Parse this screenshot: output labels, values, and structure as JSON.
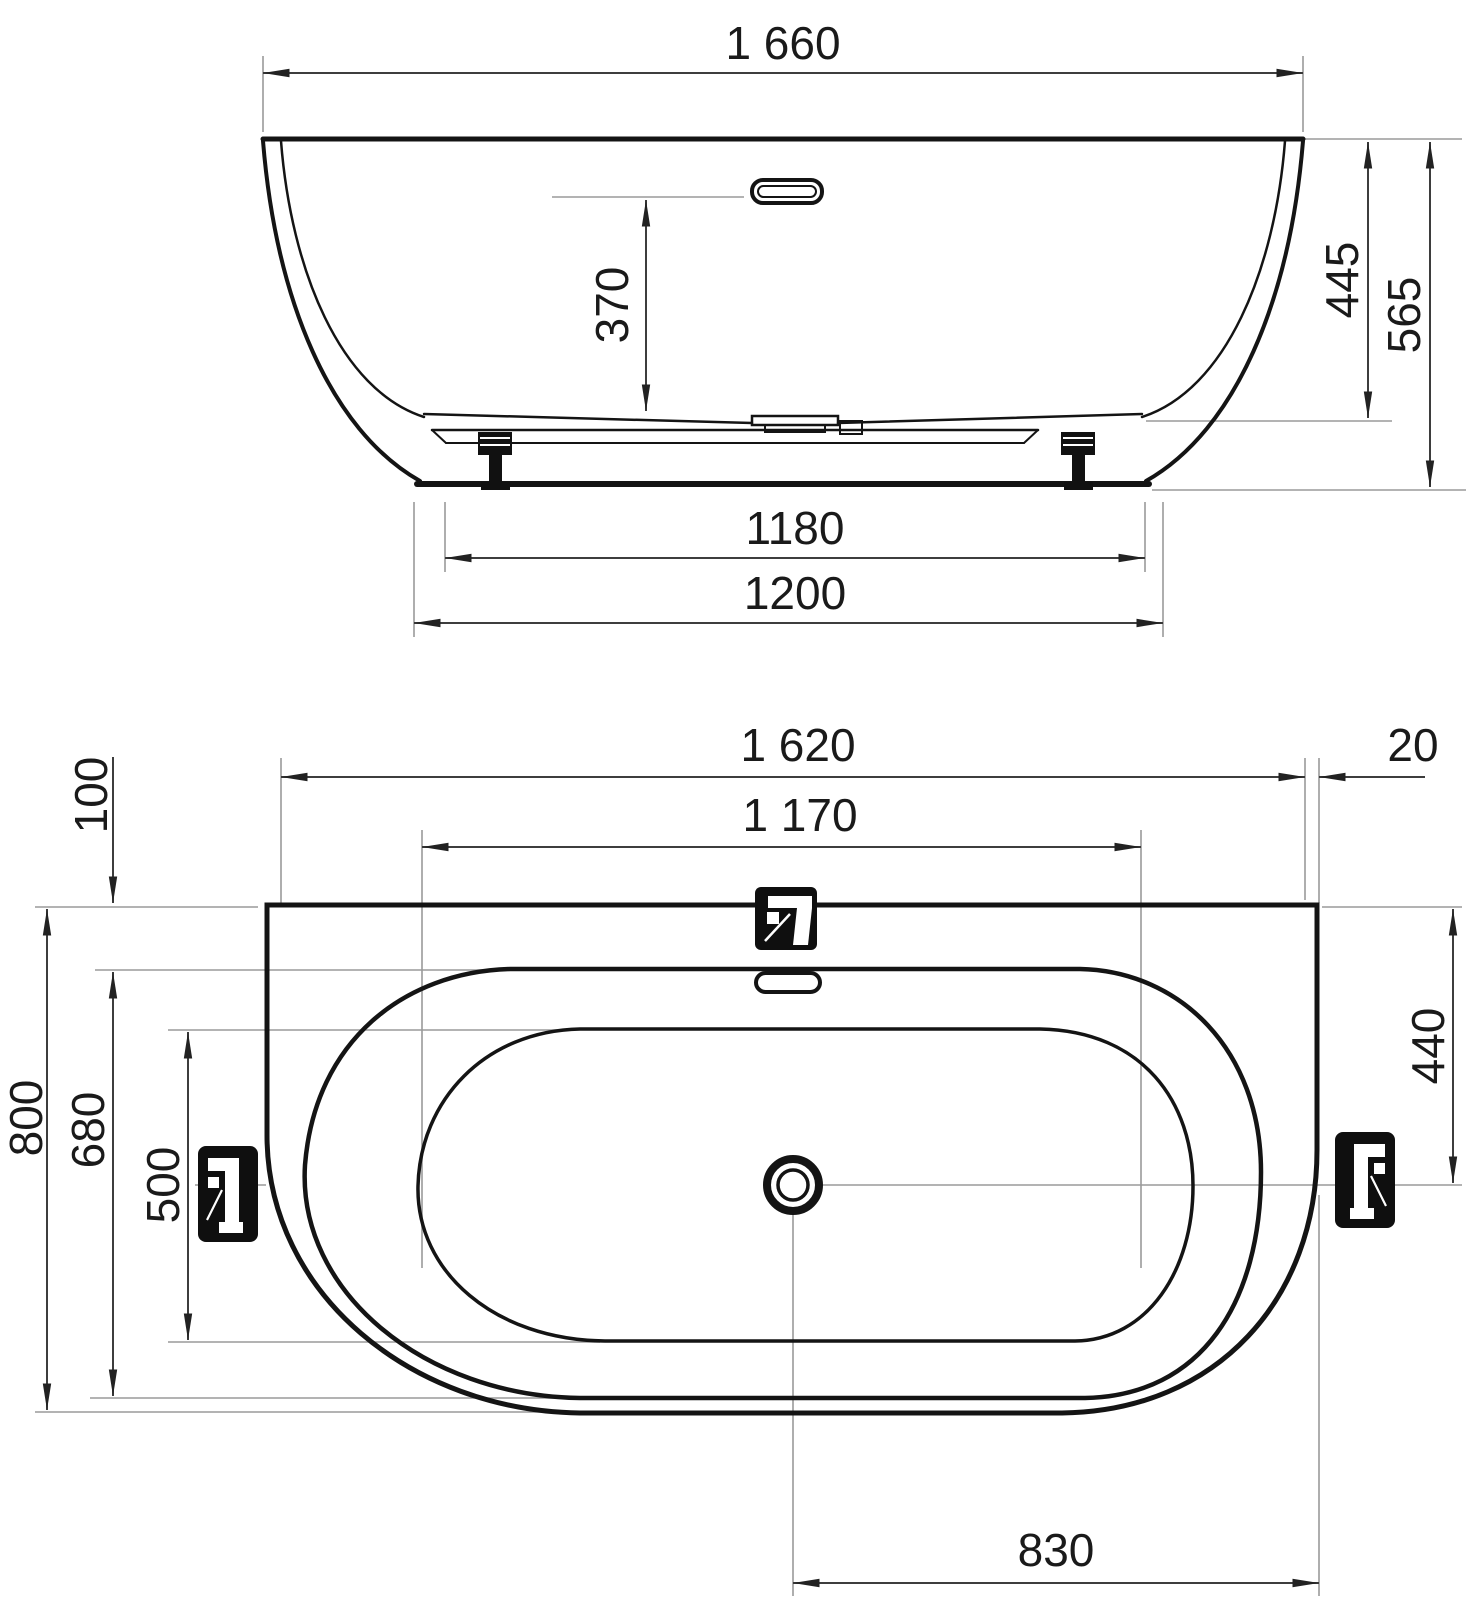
{
  "drawing": {
    "kind": "technical-dimension-drawing",
    "subject": "wall-faced freestanding bathtub — front elevation (top) and plan view (bottom)",
    "units": "mm",
    "colors": {
      "background": "#ffffff",
      "object_line": "#141414",
      "dimension_line": "#3d3d3d",
      "extension_line": "#9a9a9a",
      "pictogram": "#0f0f0f"
    },
    "icons": {
      "deck_faucet": "faucet-icon",
      "left_faucet": "faucet-icon-rotated",
      "right_faucet": "faucet-icon-rotated-mirror",
      "drain": "drain-circle-icon",
      "overflow": "overflow-slot-icon"
    }
  },
  "dims": {
    "side": {
      "overall": "1 660",
      "overflow": "370",
      "to_ledge": "445",
      "overall_h": "565",
      "base_inner": "1180",
      "base_outer": "1200"
    },
    "plan": {
      "body": "1 620",
      "lip": "20",
      "inner_len": "1 170",
      "back": "100",
      "overall_w": "800",
      "inner_w": "680",
      "floor_w": "500",
      "axis": "440",
      "drain": "830"
    }
  }
}
